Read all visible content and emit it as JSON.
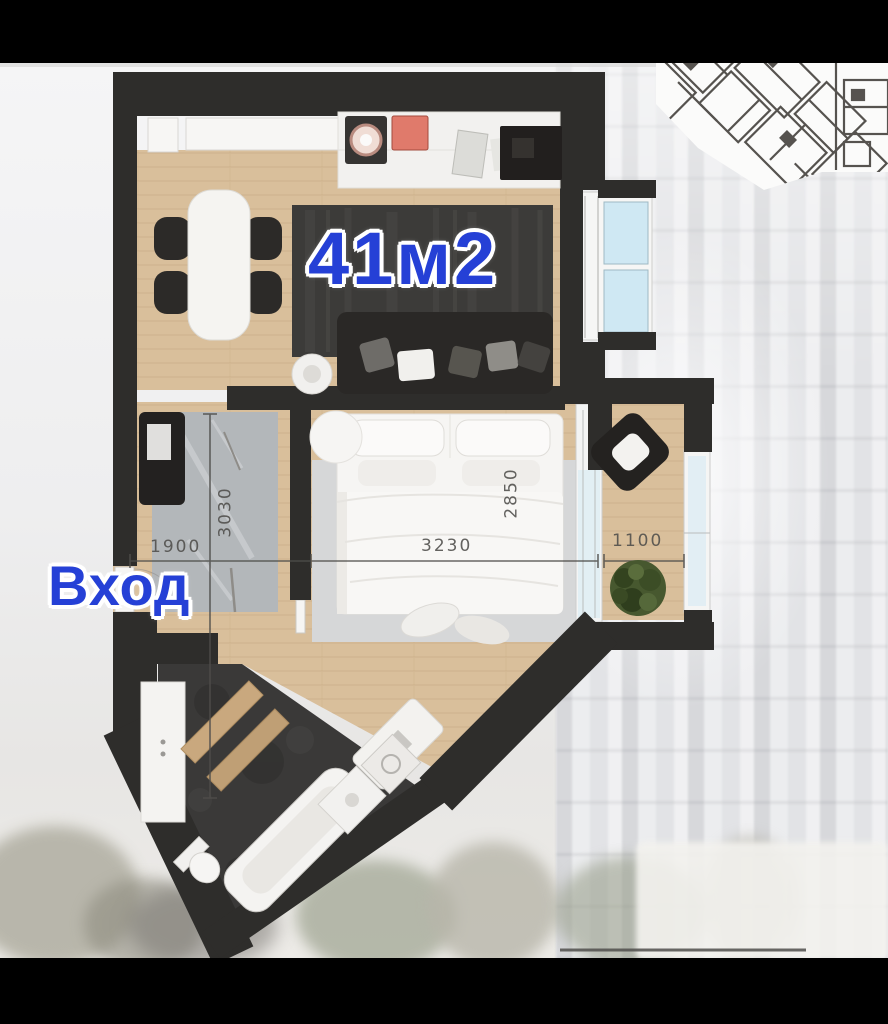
{
  "floorplan": {
    "area_label": "41м2",
    "entrance_label": "Вход",
    "dimensions": {
      "hallway_width": "1900",
      "hallway_depth": "3030",
      "bedroom_width": "3230",
      "bedroom_depth": "2850",
      "balcony_width": "1100"
    },
    "colors": {
      "bar": "#000000",
      "bg": "#f1f1f2",
      "facade": "#d6d7da",
      "wall": "#2e2d2b",
      "wood": "#d9bf9b",
      "wood-line": "#c2a47d",
      "tile": "#3a3938",
      "rug-dark": "#3c3b39",
      "rug-gray": "#b3b7ba",
      "rug-light": "#d6d7d8",
      "white": "#f4f3f1",
      "glass": "#cfe8f3",
      "stove": "#e07a6b",
      "plant": "#47582f",
      "dim": "#4f4e4b",
      "blue": "#2540d6"
    }
  }
}
